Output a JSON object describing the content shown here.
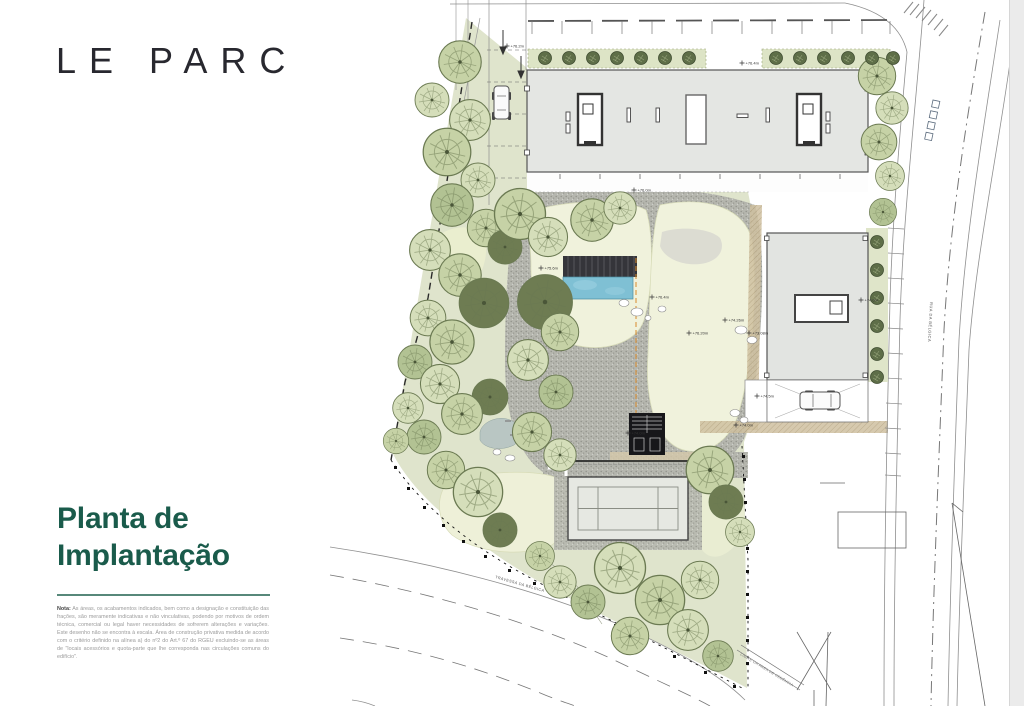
{
  "brand": {
    "logo": "LE PARC"
  },
  "panel": {
    "title_line1": "Planta de",
    "title_line2": "Implantação",
    "note_label": "Nota:",
    "note_text": "As áreas, os acabamentos indicados, bem como a designação e constituição das frações, são meramente indicativas e não vinculativas, podendo por motivos de ordem técnica, comercial ou legal haver necessidades de sofrerem alterações e variações. Este desenho não se encontra à escala. Área de construção privativa medida de acordo com o critério definido na alínea a) do nº2 do Art.º 67 do RGEU excluindo-se as áreas de \"locais acessórios e quota-parte que lhe corresponda nas circulações comuns do edifício\"."
  },
  "plan": {
    "streets": {
      "rua": "RUA DA BÉLGICA",
      "travessa": "TRAVESSA DA BÉLGICA",
      "limite": "LIMITE DA ÁREA DE CEDÊNCIA"
    },
    "markers": [
      "+76.2m",
      "+76.4m",
      "+76.0m",
      "+75.6m",
      "+76.4m",
      "+76.20m",
      "+74.26m",
      "+73.08m",
      "+74.0m",
      "+74.5m",
      "+74.6m",
      "+74.0m"
    ]
  },
  "colors": {
    "title_green": "#1a5b4b",
    "pool_blue": "#7fc0d4",
    "lawn": "#f0f2dc",
    "canopy_green": "#ccd7ae",
    "gravel_grey": "#b5b6ae",
    "tan_path": "#cfc0a0"
  }
}
